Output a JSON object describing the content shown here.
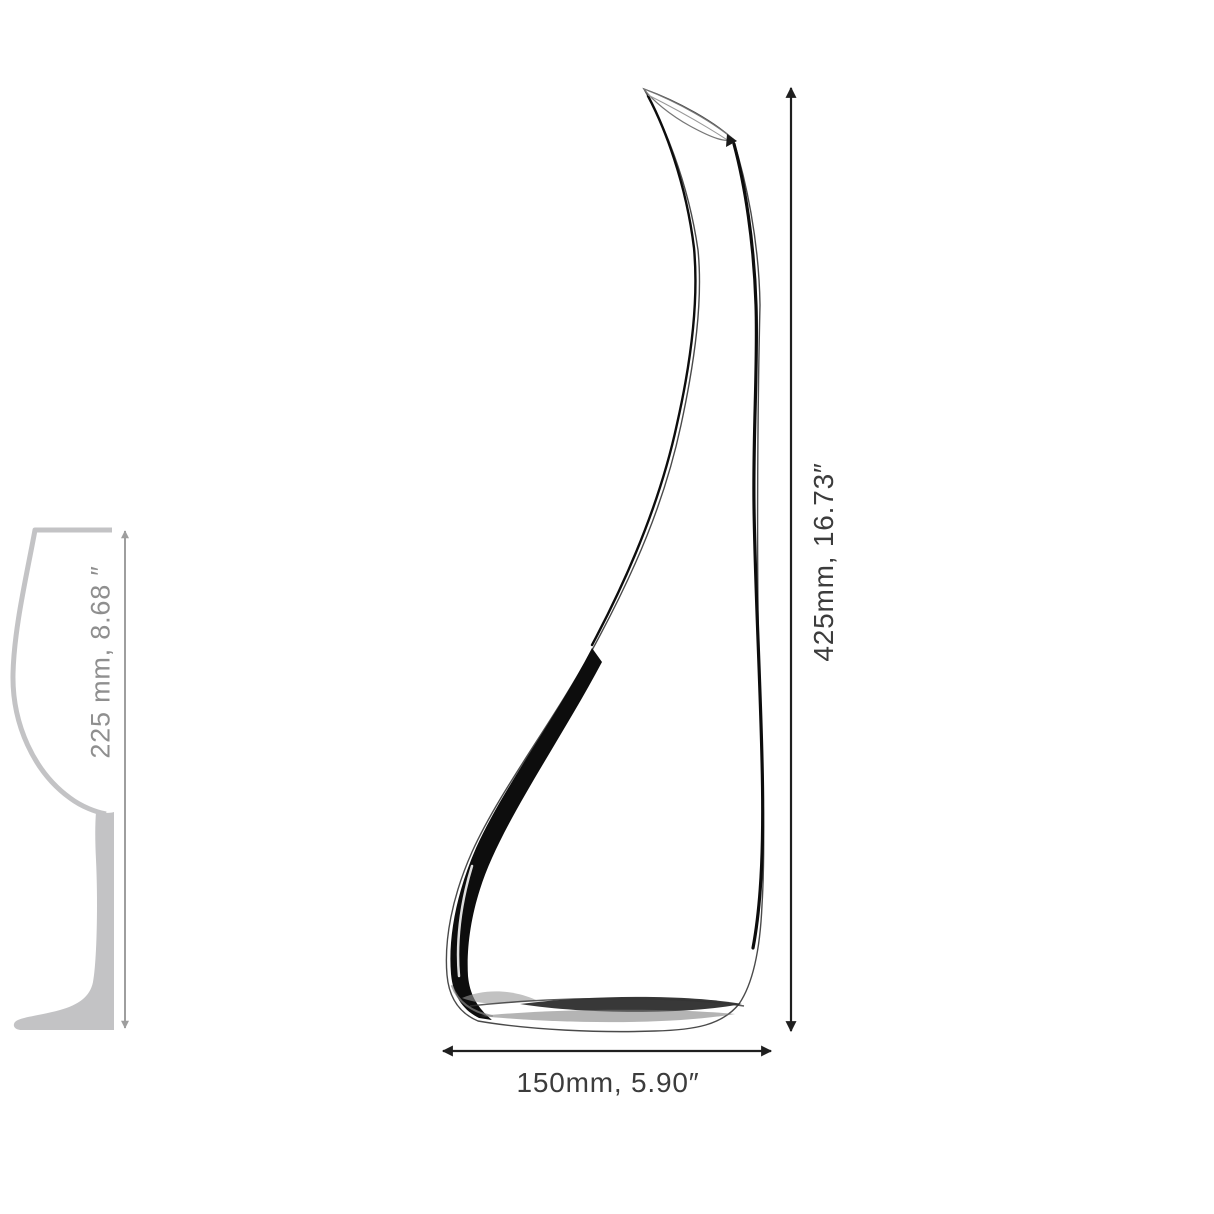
{
  "page": {
    "background": "#ffffff"
  },
  "diagram": {
    "type": "product-dimension-diagram",
    "subject": "decanter-outline-drawing",
    "reference_object": "wine-glass-silhouette",
    "labels": {
      "glass_height": "225 mm, 8.68 ″",
      "decanter_height": "425mm, 16.73″",
      "decanter_width": "150mm, 5.90″"
    },
    "colors": {
      "page_bg": "#ffffff",
      "ink": "#0d0d0d",
      "outline_gray": "#4a4a4a",
      "dim_black": "#1f1f1f",
      "text_black": "#3c3c3c",
      "dim_gray": "#9e9e9e",
      "text_gray": "#8f8f8f",
      "glass_gray": "#c3c3c5"
    }
  }
}
